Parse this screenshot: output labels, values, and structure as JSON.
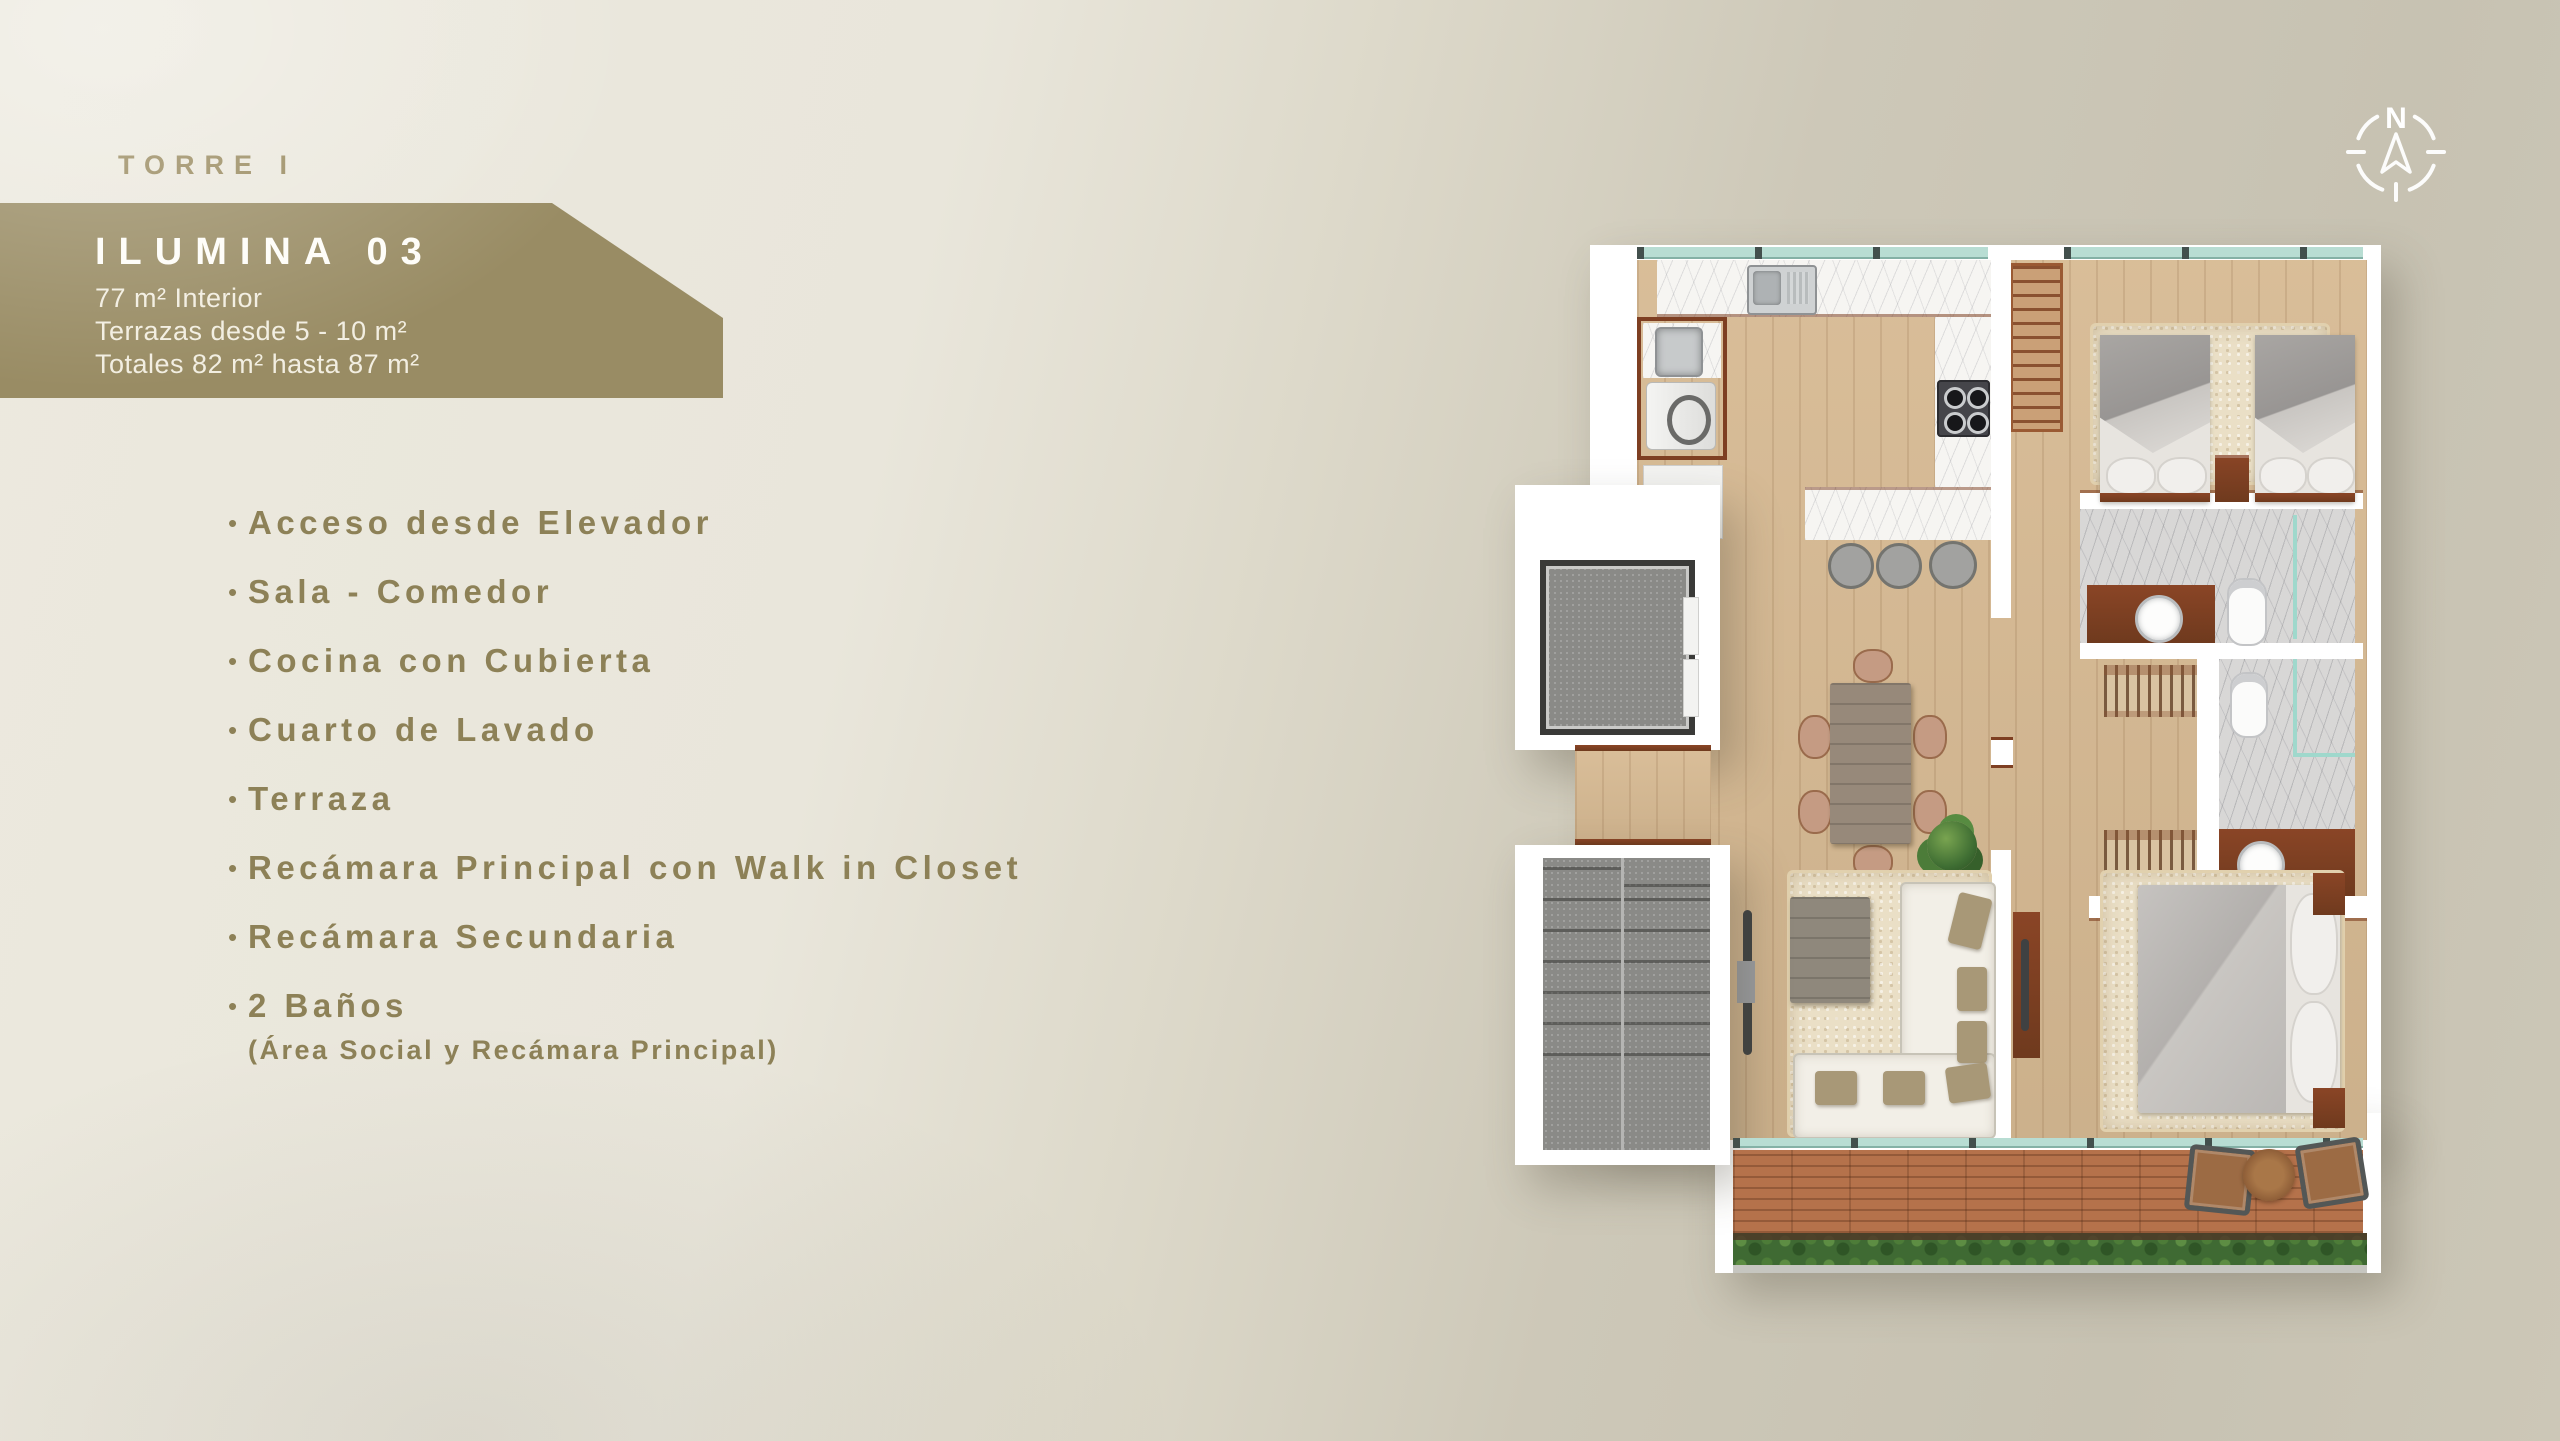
{
  "canvas": {
    "width": 2560,
    "height": 1441,
    "bg_light": "#e9e6db",
    "bg_dark": "#c8c3b3"
  },
  "header": {
    "tower": "TORRE I",
    "color": "#97885c"
  },
  "banner": {
    "bg": "#998c64",
    "title": "ILUMINA 03",
    "title_color": "#fefdf8",
    "lines": [
      "77 m² Interior",
      "Terrazas desde 5 - 10 m²",
      "Totales 82 m² hasta 87 m²"
    ],
    "text_color": "#f2eee1"
  },
  "features": {
    "bullet": "•",
    "color": "#8d8157",
    "items": [
      {
        "label": "Acceso desde Elevador"
      },
      {
        "label": "Sala - Comedor"
      },
      {
        "label": "Cocina con Cubierta"
      },
      {
        "label": "Cuarto de Lavado"
      },
      {
        "label": "Terraza"
      },
      {
        "label": "Recámara Principal con Walk in Closet"
      },
      {
        "label": "Recámara Secundaria"
      },
      {
        "label": "2 Baños",
        "sublabel": "(Área Social y Recámara Principal)"
      }
    ]
  },
  "compass": {
    "label": "N",
    "color": "#ffffff"
  },
  "floorplan": {
    "regions": [
      "kitchen",
      "laundry-nook",
      "dining",
      "living",
      "terrace",
      "master-bedroom",
      "secondary-bedroom",
      "social-bathroom",
      "master-bathroom",
      "walk-in-closet",
      "elevator",
      "stairs"
    ],
    "palette": {
      "wall": "#ffffff",
      "wood": "#d7ba93",
      "marble_white": "#f6f5f2",
      "marble_gray": "#d8d7d6",
      "cherry_wood": "#7e3f22",
      "stone_gray": "#8a8a87",
      "rug": "#eadfc6",
      "glass": "#b8ddd3",
      "deck_brick": "#b5724b",
      "hedge_green": "#3f6a33"
    }
  }
}
